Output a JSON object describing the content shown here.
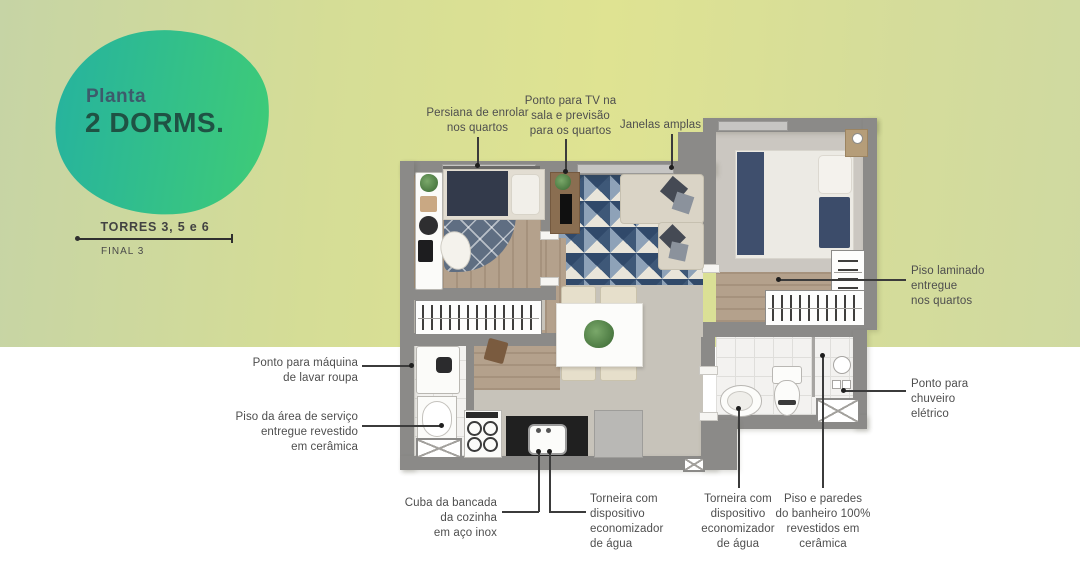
{
  "badge": {
    "line1": "Planta",
    "line2": "2 DORMS."
  },
  "plan_info": {
    "towers": "TORRES 3, 5 e 6",
    "final": "FINAL 3"
  },
  "callouts": {
    "persiana": "Persiana de enrolar\nnos quartos",
    "tv": "Ponto para TV na\nsala e previsão\npara os quartos",
    "janelas": "Janelas amplas",
    "piso_laminado": "Piso laminado\nentregue\nnos quartos",
    "chuveiro": "Ponto para\nchuveiro\nelétrico",
    "maquina_lavar": "Ponto para máquina\nde lavar roupa",
    "piso_servico": "Piso da área de serviço\nentregue revestido\nem cerâmica",
    "cuba": "Cuba da bancada\nda cozinha\nem aço inox",
    "torneira_cozinha": "Torneira com\ndispositivo\neconomizador\nde água",
    "torneira_banheiro": "Torneira com\ndispositivo\neconomizador\nde água",
    "piso_banheiro": "Piso e paredes\ndo banheiro 100%\nrevestidos em\ncerâmica"
  },
  "colors": {
    "background_green_left": "#c6d4a5",
    "background_yellow_center": "#dfe392",
    "background_green_right": "#cfd9a1",
    "white_band": "#ffffff",
    "blob_teal": "#26b39e",
    "blob_green": "#3dca79",
    "badge_text_blue": "#3d5a6b",
    "badge_text_green": "#1f5244",
    "wall_gray": "#8b8a88",
    "label_text": "#4e4e4e"
  }
}
